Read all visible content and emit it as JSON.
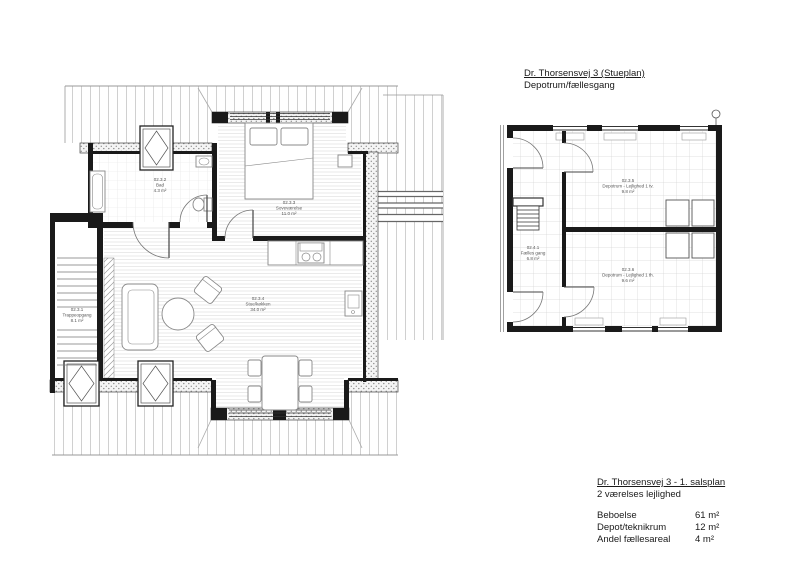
{
  "titles": {
    "stueplan": {
      "title": "Dr. Thorsensvej 3 (Stueplan)",
      "subtitle": "Depotrum/fællesgang"
    },
    "summary": {
      "title": "Dr. Thorsensvej 3 - 1. salsplan",
      "subtitle": "2 værelses lejlighed"
    }
  },
  "summary_rows": [
    {
      "label": "Beboelse",
      "value": "61 m²"
    },
    {
      "label": "Depot/teknikrum",
      "value": "12 m²"
    },
    {
      "label": "Andel fællesareal",
      "value": "4 m²"
    }
  ],
  "first_floor_plan": {
    "rooms": {
      "trappeopgang": {
        "number": "02.3.1",
        "name": "Trappeopgang",
        "area": "8.1 m²"
      },
      "bad": {
        "number": "02.3.2",
        "name": "Bad",
        "area": "4.3 m²"
      },
      "sovevaerelse": {
        "number": "02.3.3",
        "name": "Soveværelse",
        "area": "11.0 m²"
      },
      "stue_koekken": {
        "number": "02.3.4",
        "name": "Stue/køkken",
        "area": "34.0 m²"
      }
    }
  },
  "ground_floor_plan": {
    "rooms": {
      "faelles_gang": {
        "number": "02.4.1",
        "name": "Fælles gang",
        "area": "6.8 m²"
      },
      "depot_tv": {
        "number": "02.3.5",
        "name": "Depotrum - Lejlighed 1 tv.",
        "area": "9.8 m²"
      },
      "depot_th": {
        "number": "02.3.6",
        "name": "Depotrum - Lejlighed 1 th.",
        "area": "9.6 m²"
      }
    }
  },
  "colors": {
    "wall": "#1a1a1a",
    "roof_line": "#c4c4c4",
    "label": "#555555",
    "background": "#ffffff"
  }
}
